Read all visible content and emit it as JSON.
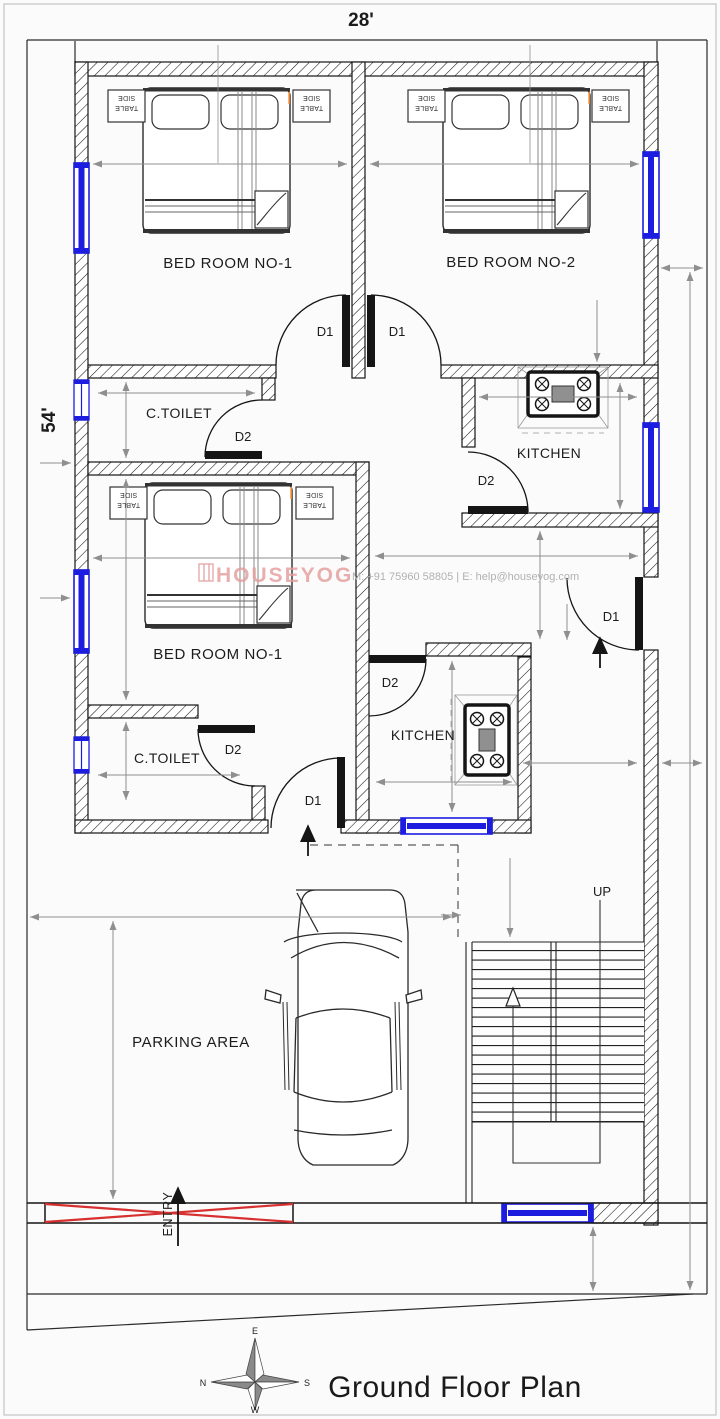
{
  "plan": {
    "title": "Ground Floor Plan",
    "plot_width_label": "28'",
    "plot_depth_label": "54'"
  },
  "rooms": {
    "bedroom_top_left": "BED ROOM NO-1",
    "bedroom_top_right": "BED ROOM NO-2",
    "bedroom_middle": "BED ROOM NO-1",
    "toilet_top": "C.TOILET",
    "toilet_bottom": "C.TOILET",
    "kitchen_top": "KITCHEN",
    "kitchen_bottom": "KITCHEN",
    "parking": "PARKING AREA"
  },
  "doors": {
    "d1": "D1",
    "d2": "D2"
  },
  "stairs": {
    "up_label": "UP"
  },
  "entry": {
    "label": "ENTRY"
  },
  "furniture": {
    "side_table_line1": "SIDE",
    "side_table_line2": "TABLE"
  },
  "compass": {
    "east": "E",
    "west": "W",
    "north": "N",
    "south": "S"
  },
  "watermark": {
    "brand": "HOUSEYOG",
    "contact": "M: +91 75960 58805   |   E: help@houseyog.com"
  },
  "colors": {
    "window_blue": "#1d1de0",
    "gate_red": "#d63030",
    "watermark_pink": "#e49c9c",
    "dimension_gray": "#8f8f8f",
    "wall_black": "#151515"
  }
}
